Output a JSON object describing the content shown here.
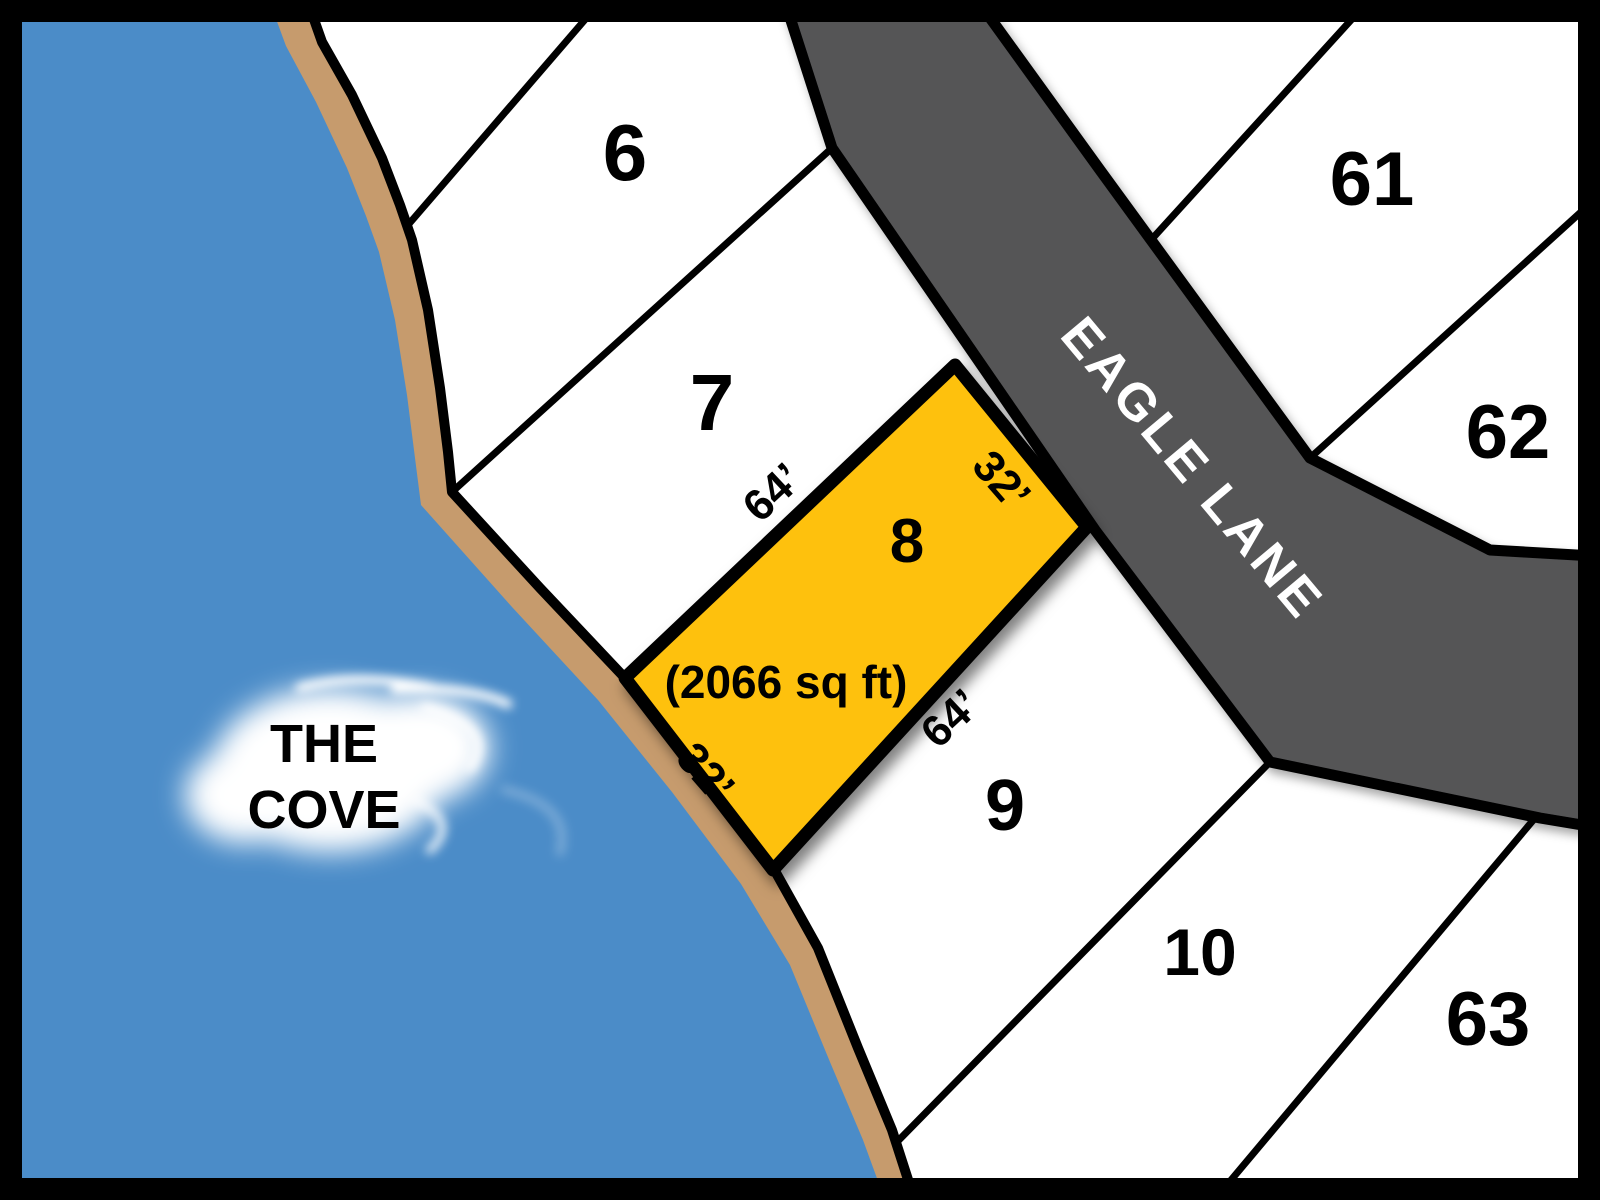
{
  "map": {
    "water": {
      "label_line1": "THE",
      "label_line2": "COVE"
    },
    "road": {
      "name": "EAGLE LANE"
    },
    "highlighted_lot": {
      "number": "8",
      "area_label": "(2066 sq ft)",
      "dim_nw": "64’",
      "dim_ne": "32’",
      "dim_se": "64’",
      "dim_sw": "32’"
    },
    "lots": [
      {
        "number": "6"
      },
      {
        "number": "7"
      },
      {
        "number": "9"
      },
      {
        "number": "10"
      },
      {
        "number": "61"
      },
      {
        "number": "62"
      },
      {
        "number": "63"
      }
    ],
    "colors": {
      "water": "#4B8CC8",
      "sand": "#C69B6D",
      "road": "#545456",
      "highlight": "#FEC10D",
      "land": "#FFFFFF",
      "road_text": "#FFFFFF"
    }
  }
}
